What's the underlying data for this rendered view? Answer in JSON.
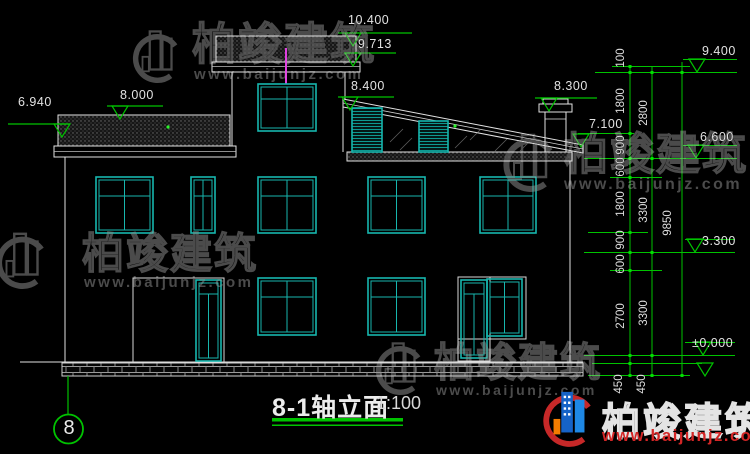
{
  "title": {
    "name": "8-1轴立面",
    "scale": "1:100"
  },
  "axis": {
    "label": "8"
  },
  "watermark": {
    "brand": "柏竣建筑",
    "url": "www.baijunjz.com"
  },
  "colors": {
    "dim_green": "#00c300",
    "cad_cyan": "#17b6ae",
    "line_white": "#e2e2e2",
    "magenta": "#e040e0",
    "logo_red": "#d42626",
    "logo_blue": "#1663c7"
  },
  "elev": {
    "m6940": "6.940",
    "m8000": "8.000",
    "m10400": "10.400",
    "m9713": "9.713",
    "m8400": "8.400",
    "m8300": "8.300",
    "m7100": "7.100",
    "m9400": "9.400",
    "m6600": "6.600",
    "m3300": "3.300",
    "m0000": "±0.000"
  },
  "chain": {
    "inner": [
      "100",
      "1800",
      "900",
      "600",
      "1800",
      "900",
      "600",
      "2700",
      "450"
    ],
    "mid": [
      "2800",
      "3300",
      "3300",
      "450"
    ],
    "total": "9850"
  }
}
